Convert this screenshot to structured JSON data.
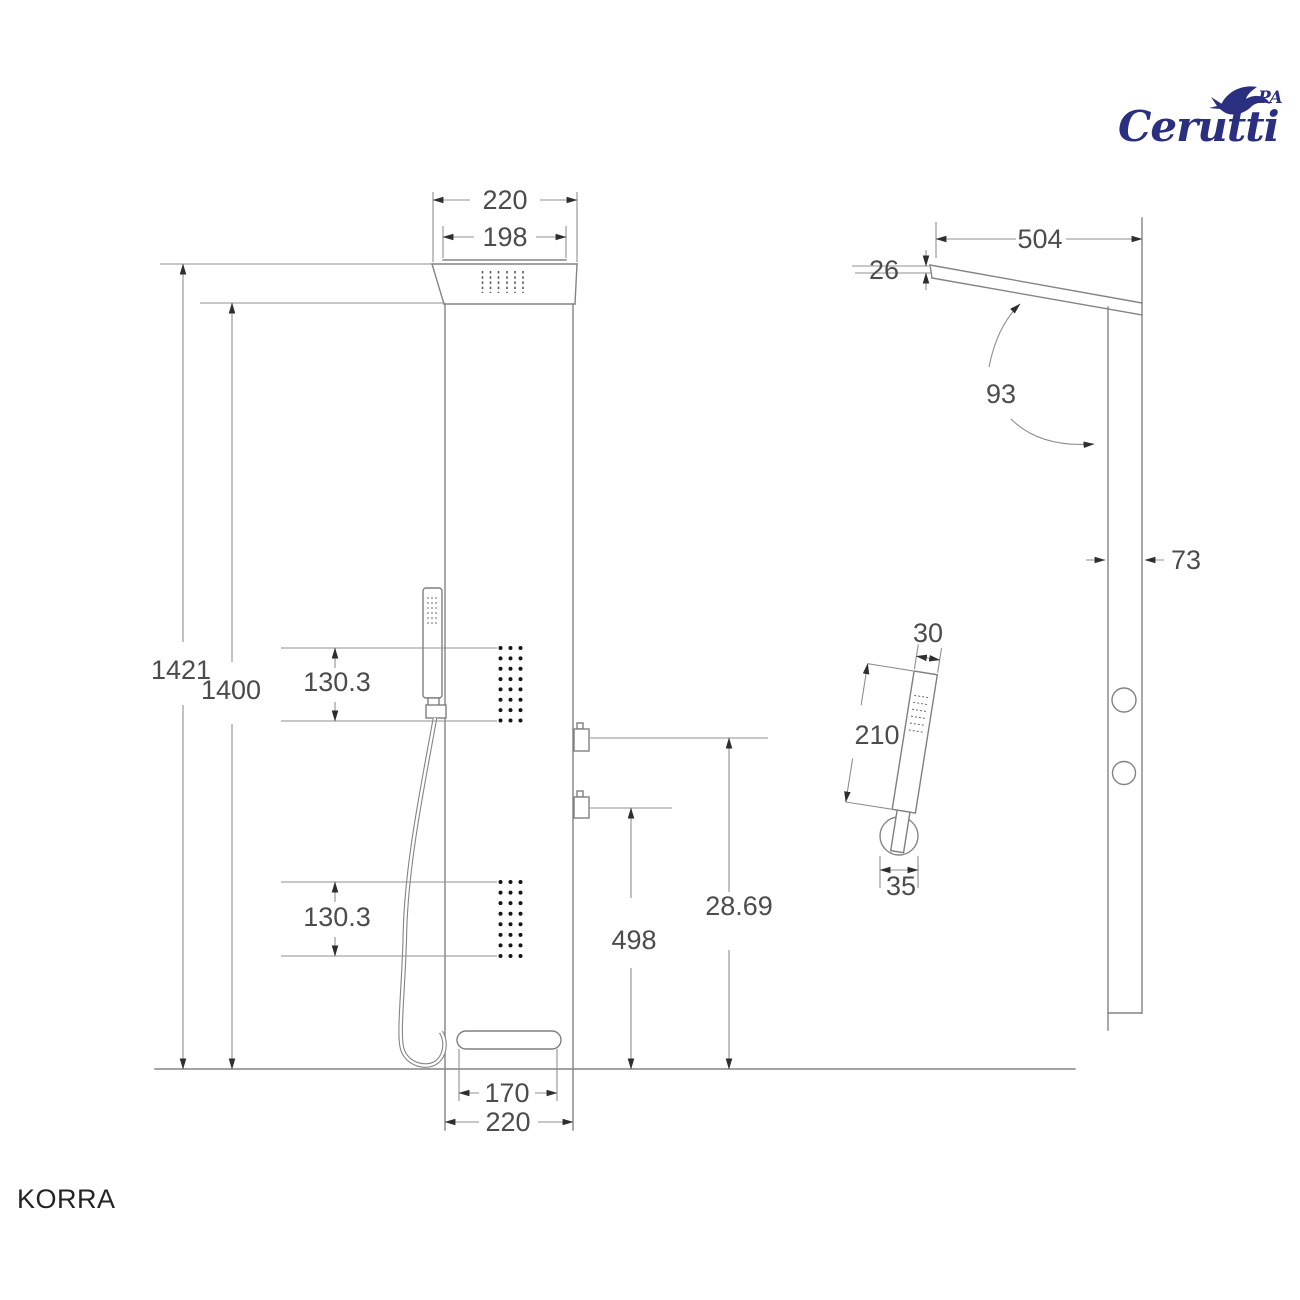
{
  "brand": {
    "name": "Cerutti",
    "sub": "PA",
    "color": "#2b2f80"
  },
  "model": {
    "name": "KORRA"
  },
  "drawing": {
    "front_view": {
      "head_outer_width": "220",
      "head_inner_width": "198",
      "total_height": "1421",
      "panel_height": "1400",
      "upper_jet_field_height": "130.3",
      "lower_jet_field_height": "130.3",
      "upper_handle_offset": "28.69",
      "lower_handle_offset": "498",
      "spout_width": "170",
      "panel_width": "220"
    },
    "side_view": {
      "arm_projection": "504",
      "arm_thickness": "26",
      "arm_angle": "93",
      "panel_depth": "73"
    },
    "hand_shower": {
      "width": "30",
      "length": "210",
      "bracket_width": "35"
    }
  }
}
